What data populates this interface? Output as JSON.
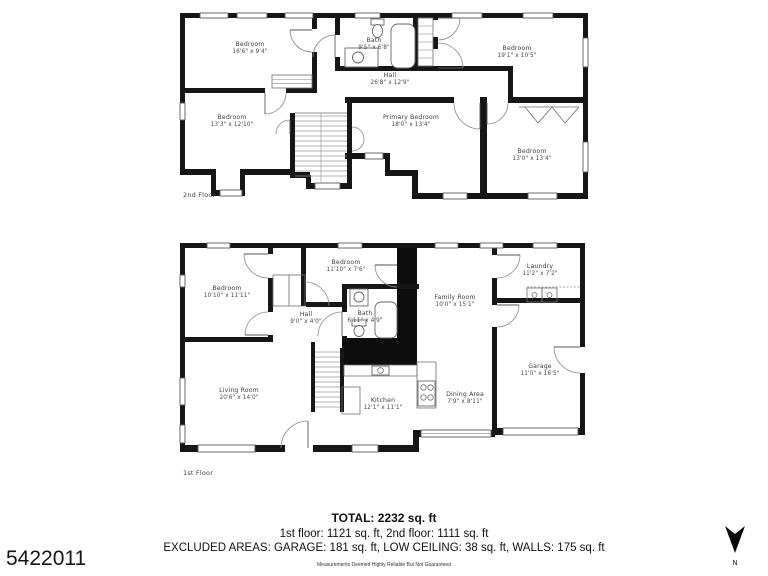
{
  "floor2": {
    "tag": "2nd Floor",
    "rooms": {
      "bedroom_tl": {
        "name": "Bedroom",
        "dims": "16'6\" x 9'4\""
      },
      "bath": {
        "name": "Bath",
        "dims": "9'5\" x 6'8\""
      },
      "bedroom_tr": {
        "name": "Bedroom",
        "dims": "19'1\" x 10'5\""
      },
      "hall": {
        "name": "Hall",
        "dims": "26'8\" x 12'9\""
      },
      "bedroom_bl": {
        "name": "Bedroom",
        "dims": "13'3\" x 12'10\""
      },
      "primary": {
        "name": "Primary Bedroom",
        "dims": "18'0\" x 13'4\""
      },
      "bedroom_br": {
        "name": "Bedroom",
        "dims": "13'0\" x 13'4\""
      }
    }
  },
  "floor1": {
    "tag": "1st Floor",
    "rooms": {
      "bedroom_tl": {
        "name": "Bedroom",
        "dims": "10'10\" x 11'11\""
      },
      "bedroom_tm": {
        "name": "Bedroom",
        "dims": "11'10\" x 7'6\""
      },
      "laundry": {
        "name": "Laundry",
        "dims": "11'2\" x 7'2\""
      },
      "hall": {
        "name": "Hall",
        "dims": "9'0\" x 4'0\""
      },
      "bath": {
        "name": "Bath",
        "dims": "6'11\" x 4'9\""
      },
      "family": {
        "name": "Family Room",
        "dims": "10'0\" x 15'1\""
      },
      "garage": {
        "name": "Garage",
        "dims": "11'0\" x 16'5\""
      },
      "living": {
        "name": "Living Room",
        "dims": "20'6\" x 14'0\""
      },
      "kitchen": {
        "name": "Kitchen",
        "dims": "12'1\" x 11'1\""
      },
      "dining": {
        "name": "Dining Area",
        "dims": "7'9\" x 8'11\""
      }
    }
  },
  "summary": {
    "total": "TOTAL: 2232 sq. ft",
    "floors": "1st floor: 1121 sq. ft, 2nd floor: 1111 sq. ft",
    "excluded": "EXCLUDED AREAS: GARAGE: 181 sq. ft, LOW CEILING: 38 sq. ft, WALLS: 175 sq. ft",
    "disclaimer": "Measurements Deemed Highly Reliable But Not Guaranteed"
  },
  "listing_id": "5422011",
  "compass_label": "N"
}
